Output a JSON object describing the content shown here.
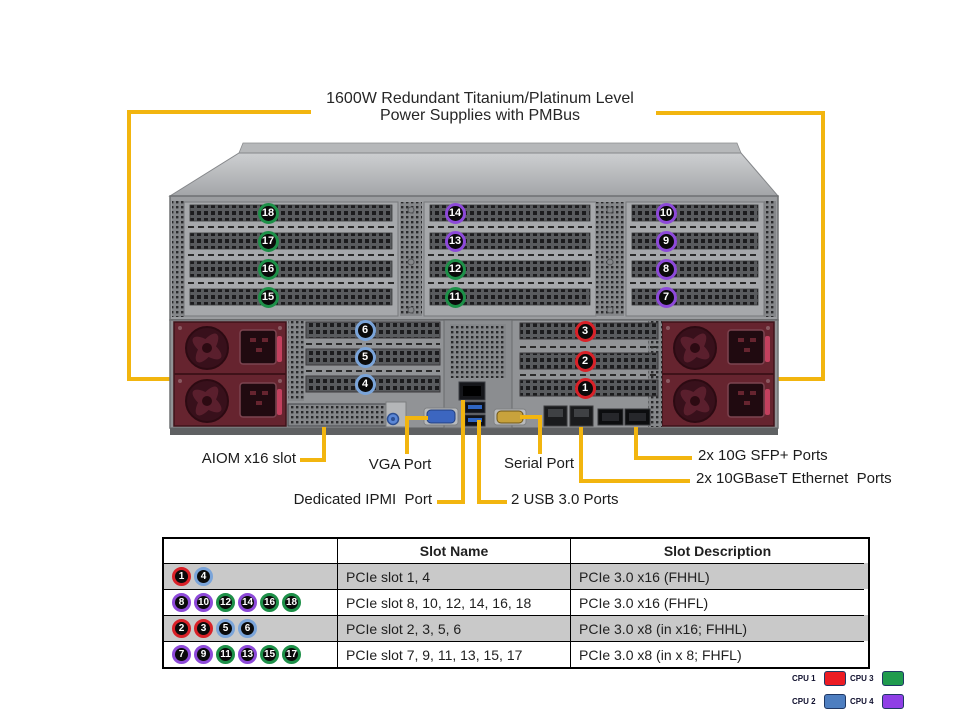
{
  "title": {
    "line1": "1600W Redundant Titanium/Platinum  Level",
    "line2": "Power Supplies with PMBus"
  },
  "accent_yellow": "#f2b50f",
  "cpu_colors": {
    "cpu1": "#d92128",
    "cpu2": "#7aa4d9",
    "cpu3": "#1d9048",
    "cpu4": "#8d49d9"
  },
  "rear_panel_slots": [
    {
      "num": 18,
      "cpu": "cpu3"
    },
    {
      "num": 17,
      "cpu": "cpu3"
    },
    {
      "num": 16,
      "cpu": "cpu3"
    },
    {
      "num": 15,
      "cpu": "cpu3"
    },
    {
      "num": 14,
      "cpu": "cpu4"
    },
    {
      "num": 13,
      "cpu": "cpu4"
    },
    {
      "num": 12,
      "cpu": "cpu3"
    },
    {
      "num": 11,
      "cpu": "cpu3"
    },
    {
      "num": 10,
      "cpu": "cpu4"
    },
    {
      "num": 9,
      "cpu": "cpu4"
    },
    {
      "num": 8,
      "cpu": "cpu4"
    },
    {
      "num": 7,
      "cpu": "cpu4"
    },
    {
      "num": 6,
      "cpu": "cpu2"
    },
    {
      "num": 5,
      "cpu": "cpu2"
    },
    {
      "num": 4,
      "cpu": "cpu2"
    },
    {
      "num": 3,
      "cpu": "cpu1"
    },
    {
      "num": 2,
      "cpu": "cpu1"
    },
    {
      "num": 1,
      "cpu": "cpu1"
    }
  ],
  "callouts": {
    "aiom": "AIOM x16 slot",
    "vga": "VGA Port",
    "serial": "Serial Port",
    "ipmi": "Dedicated IPMI  Port",
    "usb": "2 USB 3.0 Ports",
    "sfp": "2x 10G SFP+ Ports",
    "baset": "2x 10GBaseT Ethernet  Ports"
  },
  "table": {
    "headers": [
      "",
      "Slot Name",
      "Slot Description"
    ],
    "rows": [
      {
        "badges": [
          {
            "num": 1,
            "cpu": "cpu1"
          },
          {
            "num": 4,
            "cpu": "cpu2"
          }
        ],
        "slot_name": "PCIe slot 1, 4",
        "slot_description": "PCIe 3.0 x16 (FHHL)"
      },
      {
        "badges": [
          {
            "num": 8,
            "cpu": "cpu4"
          },
          {
            "num": 10,
            "cpu": "cpu4"
          },
          {
            "num": 12,
            "cpu": "cpu3"
          },
          {
            "num": 14,
            "cpu": "cpu4"
          },
          {
            "num": 16,
            "cpu": "cpu3"
          },
          {
            "num": 18,
            "cpu": "cpu3"
          }
        ],
        "slot_name": "PCIe slot 8, 10, 12, 14, 16, 18",
        "slot_description": "PCIe 3.0 x16 (FHFL)"
      },
      {
        "badges": [
          {
            "num": 2,
            "cpu": "cpu1"
          },
          {
            "num": 3,
            "cpu": "cpu1"
          },
          {
            "num": 5,
            "cpu": "cpu2"
          },
          {
            "num": 6,
            "cpu": "cpu2"
          }
        ],
        "slot_name": "PCIe slot 2, 3, 5, 6",
        "slot_description": "PCIe 3.0 x8 (in x16; FHHL)"
      },
      {
        "badges": [
          {
            "num": 7,
            "cpu": "cpu4"
          },
          {
            "num": 9,
            "cpu": "cpu4"
          },
          {
            "num": 11,
            "cpu": "cpu3"
          },
          {
            "num": 13,
            "cpu": "cpu4"
          },
          {
            "num": 15,
            "cpu": "cpu3"
          },
          {
            "num": 17,
            "cpu": "cpu3"
          }
        ],
        "slot_name": "PCIe slot 7, 9, 11, 13, 15, 17",
        "slot_description": "PCIe 3.0 x8 (in x 8; FHFL)"
      }
    ]
  },
  "legend": {
    "rows": [
      [
        {
          "label": "CPU 1",
          "color": "#ec1c24"
        },
        {
          "label": "CPU 3",
          "color": "#209b4e"
        }
      ],
      [
        {
          "label": "CPU 2",
          "color": "#4d7ec0"
        },
        {
          "label": "CPU 4",
          "color": "#8f3fe6"
        }
      ]
    ]
  }
}
